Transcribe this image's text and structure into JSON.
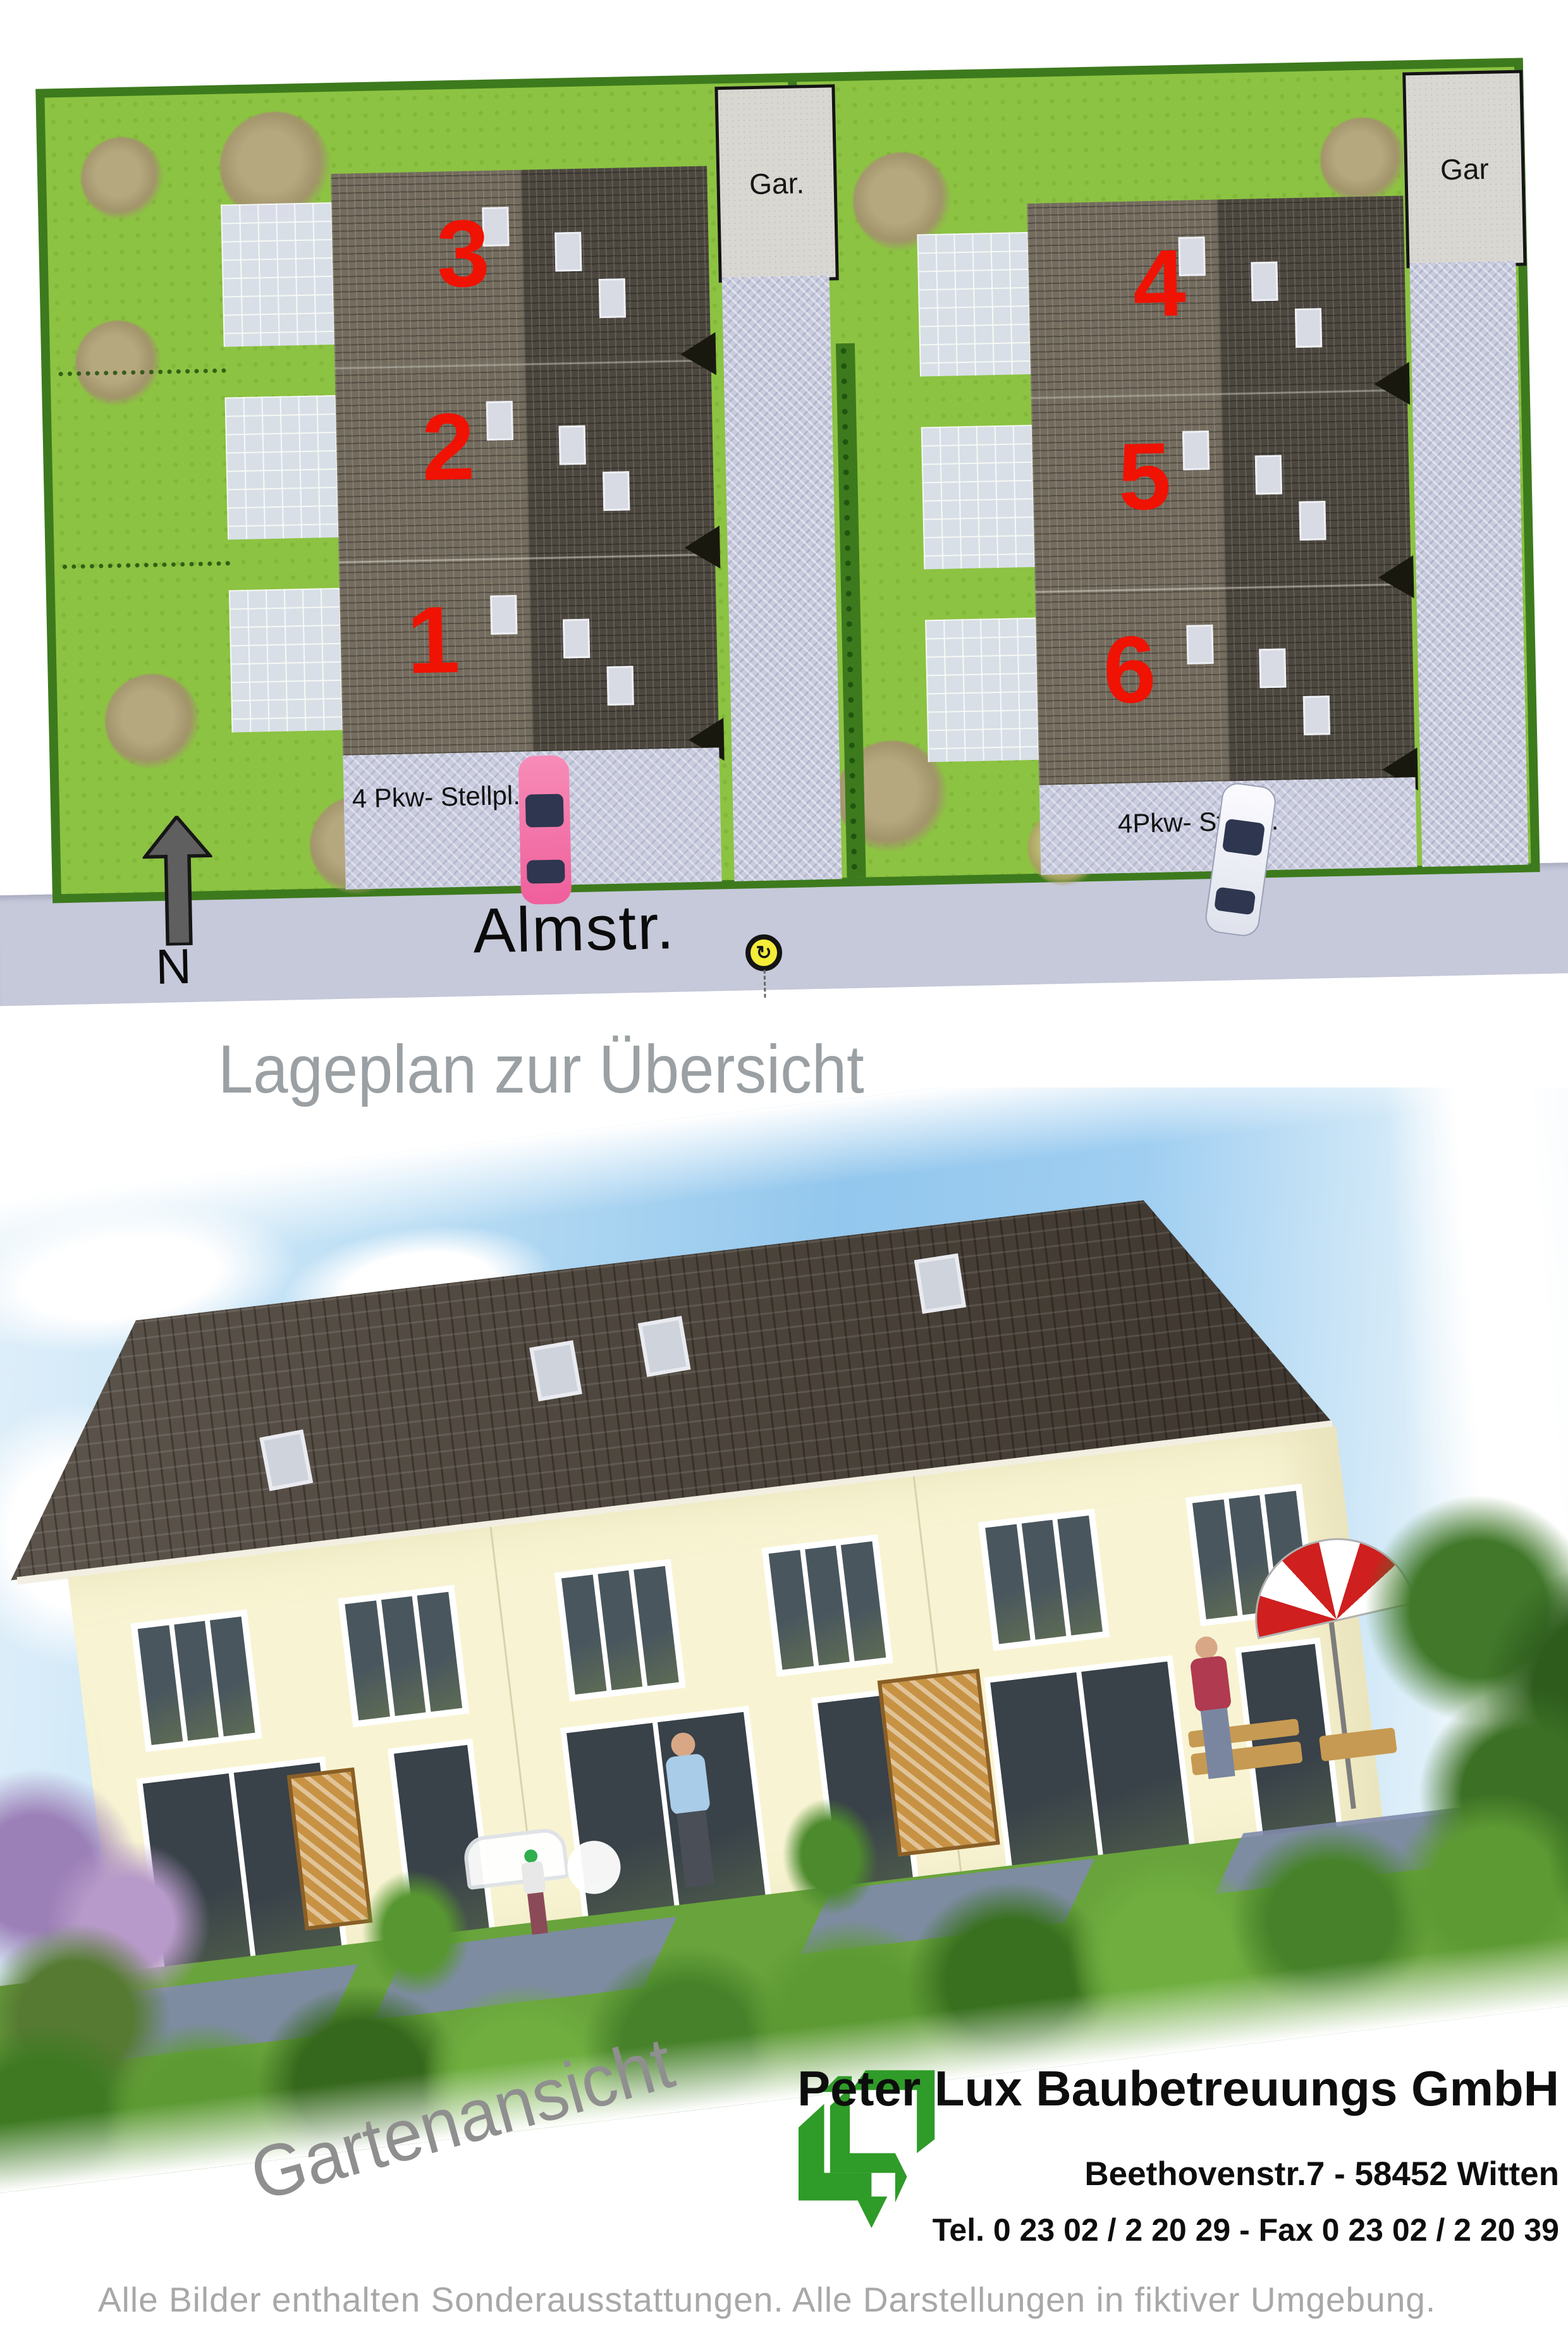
{
  "site_plan": {
    "buildings": {
      "left_units": [
        "3",
        "2",
        "1"
      ],
      "right_units": [
        "4",
        "5",
        "6"
      ]
    },
    "garage_left_label": "Gar.",
    "garage_right_label": "Gar",
    "parking_left_label": "4 Pkw- Stellpl.",
    "parking_right_label": "4Pkw- Stellpl.",
    "street_label": "Almstr.",
    "north_label": "N",
    "rotate_icon_glyph": "↻"
  },
  "captions": {
    "site_plan_caption": "Lageplan zur Übersicht",
    "garden_view_caption": "Gartenansicht"
  },
  "brand": {
    "company": "Peter Lux Baubetreuungs GmbH",
    "address": "Beethovenstr.7  -  58452 Witten",
    "phone_fax": "Tel. 0 23 02 / 2 20 29  -  Fax 0 23 02 / 2 20 39"
  },
  "footer": {
    "disclaimer": "Alle Bilder enthalten Sonderausstattungen. Alle Darstellungen in fiktiver Umgebung."
  },
  "colors": {
    "accent_red": "#f01203",
    "brand_green": "#2f9b28",
    "grass_green": "#8cc342",
    "hedge_green": "#3d7a1d",
    "street_gray": "#c6c9da",
    "roof_dark": "#4d483f",
    "wall_cream": "#f8f4d3",
    "caption_gray": "#9aa0a3"
  }
}
